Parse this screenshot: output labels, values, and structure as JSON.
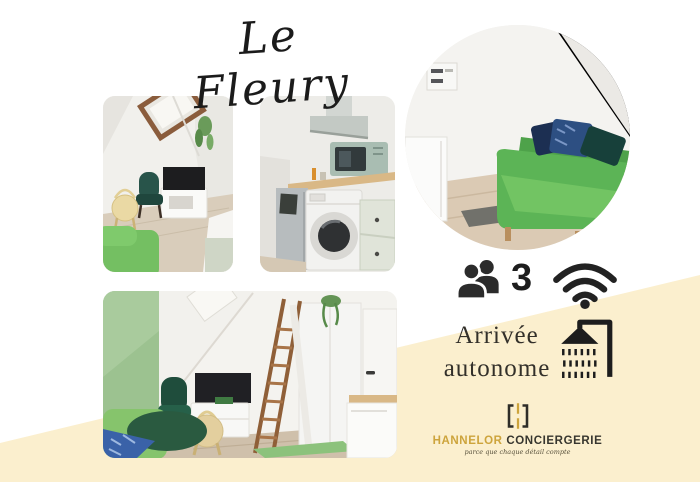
{
  "canvas": {
    "background": "#ffffff",
    "accent_cream": "#FBEFCE"
  },
  "title": {
    "text": "Le Fleury"
  },
  "photos": {
    "attic_lounge": {
      "label": "attic lounge with skylight, TV and green armchair"
    },
    "kitchen": {
      "label": "kitchenette with hood, sage microwave and washing machine"
    },
    "sofa_circle": {
      "label": "green sofa bed with blue cushions (circular photo)"
    },
    "bedroom": {
      "label": "attic room with mezzanine ladder, wardrobe, door and TV"
    }
  },
  "features": {
    "capacity": {
      "icon": "people-icon",
      "value": "3"
    },
    "wifi": {
      "icon": "wifi-icon"
    },
    "arrival": {
      "line1": "Arrivée",
      "line2": "autonome"
    },
    "shower": {
      "icon": "shower-icon"
    }
  },
  "brand": {
    "monogram_icon": "hannelor-monogram",
    "name_primary": "HANNELOR",
    "name_secondary": "CONCIERGERIE",
    "tagline": "parce que chaque détail compte",
    "colors": {
      "gold": "#CDA43C",
      "dark": "#37362F",
      "icon_black": "#222222"
    }
  }
}
